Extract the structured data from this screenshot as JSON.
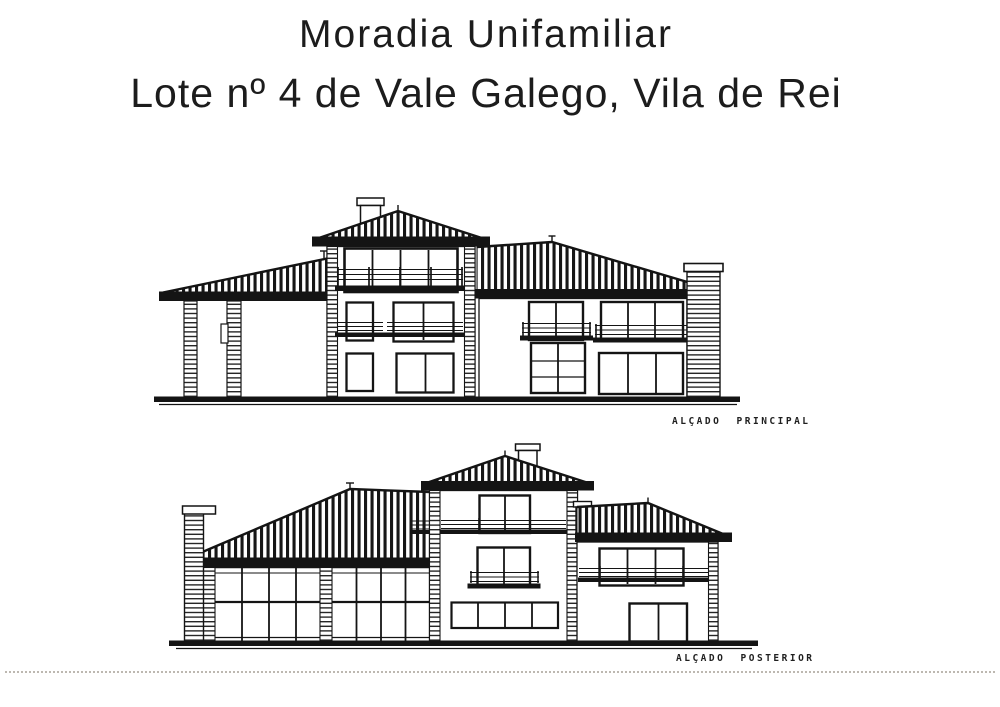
{
  "page": {
    "background": "#ffffff",
    "ink": "#141414"
  },
  "header": {
    "title_line1": "Moradia Unifamiliar",
    "title_line2": "Lote nº 4 de Vale Galego, Vila de Rei"
  },
  "elevations": {
    "principal": {
      "caption": "ALÇADO PRINCIPAL"
    },
    "posterior": {
      "caption": "ALÇADO POSTERIOR"
    }
  }
}
